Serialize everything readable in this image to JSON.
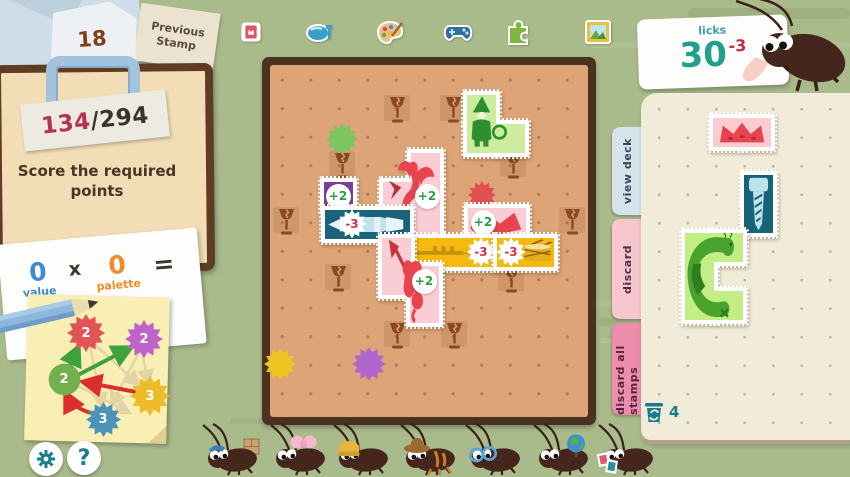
{
  "header": {
    "previous": {
      "count": "18",
      "label": "Previous Stamp"
    },
    "categories": [
      {
        "name": "mini-stamp-icon"
      },
      {
        "name": "food-icon"
      },
      {
        "name": "palette-icon"
      },
      {
        "name": "controller-icon"
      },
      {
        "name": "puzzle-icon"
      },
      {
        "name": "frame-icon"
      }
    ],
    "licks": {
      "label": "licks",
      "value": "30",
      "delta": "-3"
    }
  },
  "objective": {
    "score": "134",
    "separator": "/",
    "target": "294",
    "task": "Score the required points"
  },
  "calc": {
    "value_num": "0",
    "value_label": "value",
    "times": "x",
    "palette_num": "0",
    "palette_label": "palette",
    "equals": "="
  },
  "diagram": {
    "nodes": [
      {
        "value": "2",
        "color": "#e15356",
        "shape": "splat",
        "x": 86,
        "y": 333,
        "size": 38
      },
      {
        "value": "2",
        "color": "#c063c9",
        "shape": "splat",
        "x": 144,
        "y": 339,
        "size": 38
      },
      {
        "value": "2",
        "color": "#72b04e",
        "shape": "circle",
        "x": 64,
        "y": 379,
        "size": 33
      },
      {
        "value": "3",
        "color": "#eebc2a",
        "shape": "splat",
        "x": 150,
        "y": 396,
        "size": 40
      },
      {
        "value": "3",
        "color": "#4c93b9",
        "shape": "splat",
        "x": 103,
        "y": 419,
        "size": 35
      }
    ]
  },
  "board": {
    "goblets": [
      {
        "x": 388,
        "y": 96
      },
      {
        "x": 444,
        "y": 96
      },
      {
        "x": 333,
        "y": 152
      },
      {
        "x": 504,
        "y": 152
      },
      {
        "x": 277,
        "y": 208
      },
      {
        "x": 563,
        "y": 208
      },
      {
        "x": 329,
        "y": 265
      },
      {
        "x": 502,
        "y": 266
      },
      {
        "x": 388,
        "y": 322
      },
      {
        "x": 445,
        "y": 322
      }
    ],
    "splats": [
      {
        "color": "#7dc55e",
        "x": 326,
        "y": 123,
        "size": 32
      },
      {
        "color": "#e05050",
        "x": 468,
        "y": 181,
        "size": 28
      },
      {
        "color": "#eec423",
        "x": 264,
        "y": 348,
        "size": 32
      },
      {
        "color": "#b066cc",
        "x": 352,
        "y": 347,
        "size": 34
      }
    ],
    "stamps": [
      {
        "name": "gnome-stamp",
        "color": "#cdeca0",
        "art": "gnome",
        "cells": [
          [
            467,
            95
          ],
          [
            467,
            124
          ],
          [
            496,
            124
          ]
        ],
        "badges": []
      },
      {
        "name": "dragon-stamp",
        "color": "#f9cdd3",
        "art": "dragon",
        "cells": [
          [
            411,
            153
          ],
          [
            411,
            182
          ],
          [
            383,
            182
          ],
          [
            411,
            210
          ]
        ],
        "badges": [
          {
            "text": "+2",
            "type": "plus",
            "x": 427,
            "y": 196
          }
        ]
      },
      {
        "name": "purple-bonus-stamp",
        "color": "#7b3f98",
        "art": null,
        "cells": [
          [
            324,
            182
          ]
        ],
        "badges": [
          {
            "text": "+2",
            "type": "plus",
            "x": 338,
            "y": 196
          }
        ]
      },
      {
        "name": "rocket-stamp",
        "color": "#19647b",
        "art": "rocket",
        "cells": [
          [
            325,
            210
          ],
          [
            353,
            210
          ],
          [
            381,
            210
          ]
        ],
        "badges": [
          {
            "text": "-3",
            "type": "minus",
            "x": 352,
            "y": 224
          }
        ]
      },
      {
        "name": "fox-stamp",
        "color": "#f9cdd3",
        "art": "fox",
        "cells": [
          [
            468,
            208
          ],
          [
            497,
            208
          ]
        ],
        "badges": [
          {
            "text": "+2",
            "type": "plus",
            "x": 483,
            "y": 222
          }
        ]
      },
      {
        "name": "trumpet-stamp",
        "color": "#f5b90f",
        "art": "trumpet",
        "cells": [
          [
            410,
            238
          ],
          [
            438,
            238
          ],
          [
            466,
            238
          ]
        ],
        "badges": [
          {
            "text": "-3",
            "type": "minus",
            "x": 481,
            "y": 252
          }
        ]
      },
      {
        "name": "drum-stamp",
        "color": "#f5b90f",
        "art": "drum",
        "cells": [
          [
            497,
            238
          ],
          [
            525,
            238
          ]
        ],
        "badges": [
          {
            "text": "-3",
            "type": "minus",
            "x": 511,
            "y": 252
          }
        ]
      },
      {
        "name": "cupid-stamp",
        "color": "#f9cdd3",
        "art": "cupid",
        "cells": [
          [
            382,
            238
          ],
          [
            382,
            266
          ],
          [
            410,
            266
          ],
          [
            410,
            294
          ]
        ],
        "badges": [
          {
            "text": "+2",
            "type": "plus",
            "x": 424,
            "y": 281
          }
        ]
      }
    ]
  },
  "tabs": [
    {
      "id": "view-deck",
      "label": "view deck",
      "bg": "#d6e3eb",
      "fg": "#37485a"
    },
    {
      "id": "discard",
      "label": "discard",
      "bg": "#f7c6ce",
      "fg": "#4a3340"
    },
    {
      "id": "discard-all-stamps",
      "label": "discard all stamps",
      "bg": "#ee8cab",
      "fg": "#58243c"
    }
  ],
  "hand": {
    "stamps": [
      {
        "name": "crown-stamp",
        "color": "#f9ccd1",
        "art": "crown",
        "cells": [
          [
            713,
            118
          ],
          [
            742,
            118
          ]
        ],
        "badges": []
      },
      {
        "name": "screw-stamp",
        "color": "#16637a",
        "art": "screw",
        "cells": [
          [
            744,
            175
          ],
          [
            744,
            204
          ]
        ],
        "badges": []
      },
      {
        "name": "caterpillar-stamp",
        "color": "#c3ed87",
        "art": "caterpillar",
        "cells": [
          [
            685,
            233
          ],
          [
            685,
            262
          ],
          [
            685,
            291
          ],
          [
            714,
            233
          ],
          [
            714,
            291
          ]
        ],
        "badges": []
      }
    ],
    "discard_count": "4"
  },
  "crew": {
    "roaches": [
      {
        "accessory": "box",
        "x": 200
      },
      {
        "accessory": "bow",
        "x": 268
      },
      {
        "accessory": "beanie",
        "x": 331
      },
      {
        "accessory": "cowboy-hat",
        "x": 398
      },
      {
        "accessory": "glasses",
        "x": 463
      },
      {
        "accessory": "globe",
        "x": 531
      },
      {
        "accessory": "stamps",
        "x": 596
      }
    ]
  },
  "footer": {
    "help_label": "?"
  },
  "colors": {
    "background": "#a9ba8b",
    "board_wood": "#49321f",
    "board_paper": "#dca477",
    "teal_accent": "#1b7d8e",
    "licks_teal": "#21a08e",
    "delta_red": "#c42a44",
    "score_red": "#b23355",
    "plus_green": "#2f9e41",
    "minus_red": "#d03246",
    "value_blue": "#3d8bd4",
    "palette_orange": "#ef8d2a"
  }
}
